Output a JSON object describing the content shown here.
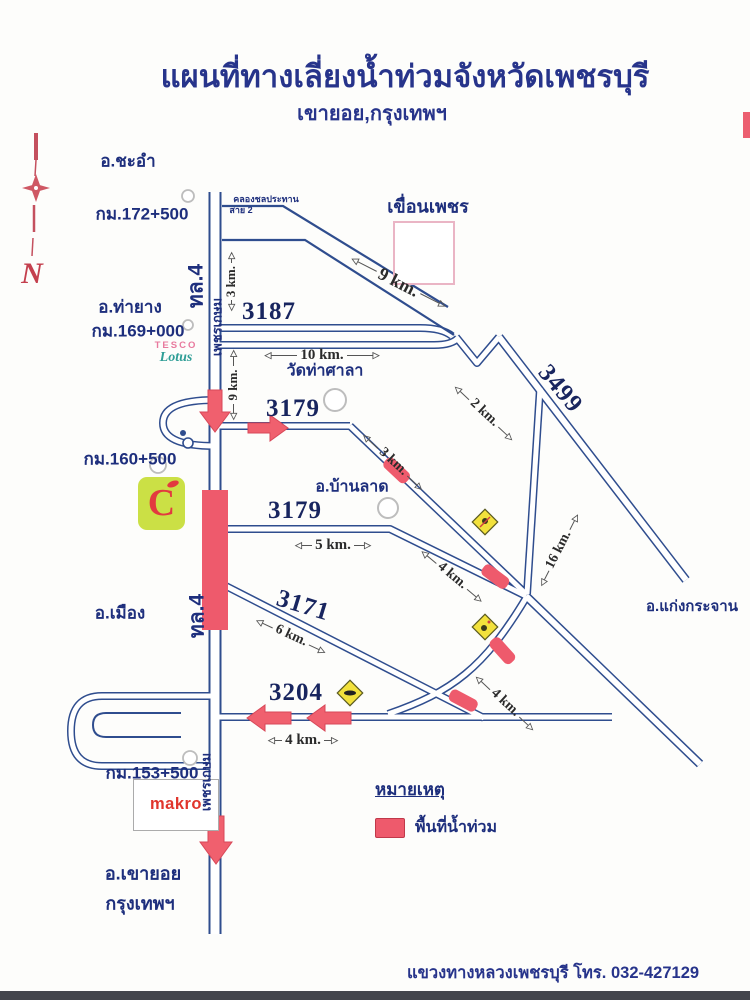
{
  "page": {
    "title": "แผนที่ทางเลี่ยงน้ำท่วมจังหวัดเพชรบุรี",
    "subtitle": "เขายอย,กรุงเทพฯ",
    "footer": "แขวงทางหลวงเพชรบุรี  โทร. 032-427129"
  },
  "compass": {
    "label": "N"
  },
  "legend": {
    "title": "หมายเหตุ",
    "flood_label": "พื้นที่น้ำท่วม"
  },
  "logos": {
    "tesco_top": "TESCO",
    "tesco_bottom": "Lotus",
    "bigc": "C",
    "makro": "makro"
  },
  "icons": {
    "arrowhead_left": "◁",
    "arrowhead_right": "▷"
  },
  "colors": {
    "road": "#2f4d8e",
    "flood": "#ee5a6c",
    "accent_red": "#f0606e",
    "sign_yellow": "#f2e13c",
    "text_navy": "#1e2f7d"
  },
  "map": {
    "labels": [
      {
        "name": "district-chaam",
        "text": "อ.ชะอำ",
        "cx": 128,
        "cy": 161,
        "size": 17
      },
      {
        "name": "km-marker-172",
        "text": "กม.172+500",
        "cx": 142,
        "cy": 214,
        "size": 17
      },
      {
        "name": "district-thayang",
        "text": "อ.ท่ายาง",
        "cx": 130,
        "cy": 307,
        "size": 17
      },
      {
        "name": "km-marker-169",
        "text": "กม.169+000",
        "cx": 138,
        "cy": 331,
        "size": 17
      },
      {
        "name": "km-marker-160",
        "text": "กม.160+500",
        "cx": 130,
        "cy": 459,
        "size": 17
      },
      {
        "name": "district-mueang",
        "text": "อ.เมือง",
        "cx": 120,
        "cy": 613,
        "size": 17
      },
      {
        "name": "km-marker-153",
        "text": "กม.153+500",
        "cx": 152,
        "cy": 773,
        "size": 17
      },
      {
        "name": "district-khaoyoi",
        "text": "อ.เขายอย",
        "cx": 143,
        "cy": 873,
        "size": 18
      },
      {
        "name": "bangkok-label",
        "text": "กรุงเทพฯ",
        "cx": 140,
        "cy": 903,
        "size": 18
      },
      {
        "name": "highway-4-label-top",
        "text": "ทล.4",
        "cx": 196,
        "cy": 286,
        "size": 21,
        "rot": -90
      },
      {
        "name": "highway-4-label-bottom",
        "text": "ทล.4",
        "cx": 197,
        "cy": 616,
        "size": 21,
        "rot": -90
      },
      {
        "name": "phetkasem-label-top",
        "text": "เพชรเกษม",
        "cx": 217,
        "cy": 327,
        "size": 13,
        "rot": -90
      },
      {
        "name": "phetkasem-label-bottom",
        "text": "เพชรเกษม",
        "cx": 206,
        "cy": 782,
        "size": 13,
        "rot": -90
      },
      {
        "name": "canal-label-line1",
        "text": "คลองชลประทาน",
        "cx": 266,
        "cy": 199,
        "size": 9,
        "cls": "canal"
      },
      {
        "name": "canal-label-line2",
        "text": "สาย 2",
        "cx": 241,
        "cy": 210,
        "size": 9,
        "cls": "canal"
      },
      {
        "name": "phet-dam-label",
        "text": "เขื่อนเพชร",
        "cx": 428,
        "cy": 206,
        "size": 18
      },
      {
        "name": "wat-thasala-label",
        "text": "วัดท่าศาลา",
        "cx": 325,
        "cy": 371,
        "size": 16
      },
      {
        "name": "district-banlat",
        "text": "อ.บ้านลาด",
        "cx": 352,
        "cy": 487,
        "size": 16
      },
      {
        "name": "district-kaengkrachan",
        "text": "อ.แก่งกระจาน",
        "cx": 692,
        "cy": 606,
        "size": 15
      },
      {
        "name": "route-3187",
        "text": "3187",
        "cx": 269,
        "cy": 312,
        "size": 25,
        "cls": "route"
      },
      {
        "name": "route-3179-upper",
        "text": "3179",
        "cx": 293,
        "cy": 409,
        "size": 25,
        "cls": "route"
      },
      {
        "name": "route-3179-lower",
        "text": "3179",
        "cx": 295,
        "cy": 511,
        "size": 25,
        "cls": "route"
      },
      {
        "name": "route-3171",
        "text": "3171",
        "cx": 303,
        "cy": 606,
        "size": 25,
        "rot": 17,
        "cls": "route"
      },
      {
        "name": "route-3204",
        "text": "3204",
        "cx": 296,
        "cy": 693,
        "size": 25,
        "cls": "route"
      },
      {
        "name": "route-3499",
        "text": "3499",
        "cx": 560,
        "cy": 389,
        "size": 25,
        "rot": 50,
        "cls": "route"
      }
    ],
    "distances": [
      {
        "name": "distance-3km-north",
        "text": "3 km.",
        "cx": 231,
        "cy": 283,
        "w": 58,
        "rot": -90,
        "size": 13
      },
      {
        "name": "distance-9km-canal",
        "text": "9 km.",
        "cx": 398,
        "cy": 281,
        "w": 105,
        "rot": 27,
        "size": 18
      },
      {
        "name": "distance-10km",
        "text": "10 km.",
        "cx": 322,
        "cy": 356,
        "w": 115,
        "rot": 0,
        "size": 15
      },
      {
        "name": "distance-9km-vertical",
        "text": "9 km.",
        "cx": 233,
        "cy": 386,
        "w": 70,
        "rot": -90,
        "size": 13
      },
      {
        "name": "distance-2km",
        "text": "2 km.",
        "cx": 484,
        "cy": 414,
        "w": 78,
        "rot": 43,
        "size": 14
      },
      {
        "name": "distance-3km-mid",
        "text": "3 km.",
        "cx": 393,
        "cy": 463,
        "w": 80,
        "rot": 43,
        "size": 14
      },
      {
        "name": "distance-5km",
        "text": "5 km.",
        "cx": 333,
        "cy": 546,
        "w": 76,
        "rot": 0,
        "size": 15
      },
      {
        "name": "distance-16km",
        "text": "16 km.",
        "cx": 559,
        "cy": 551,
        "w": 80,
        "rot": -63,
        "size": 14
      },
      {
        "name": "distance-4km-mid",
        "text": "4 km.",
        "cx": 452,
        "cy": 577,
        "w": 78,
        "rot": 40,
        "size": 14
      },
      {
        "name": "distance-6km",
        "text": "6 km.",
        "cx": 291,
        "cy": 637,
        "w": 76,
        "rot": 25,
        "size": 14
      },
      {
        "name": "distance-4km-curve",
        "text": "4 km.",
        "cx": 505,
        "cy": 704,
        "w": 78,
        "rot": 43,
        "size": 14
      },
      {
        "name": "distance-4km-south",
        "text": "4 km.",
        "cx": 303,
        "cy": 741,
        "w": 70,
        "rot": 0,
        "size": 15
      }
    ]
  }
}
